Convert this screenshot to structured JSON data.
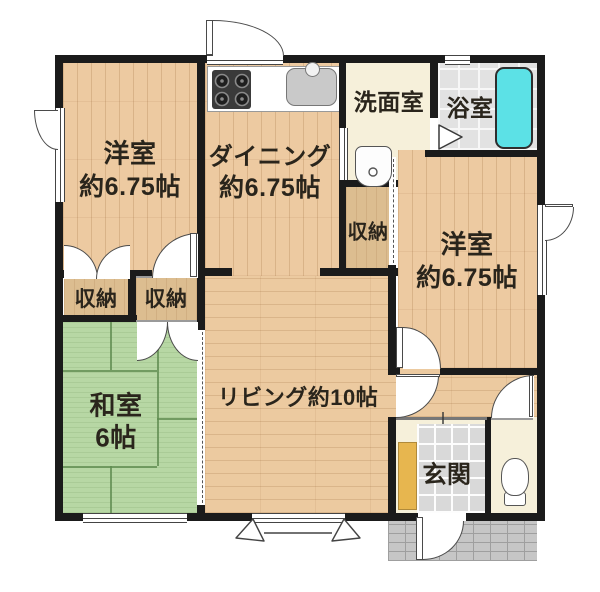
{
  "rooms": {
    "bedroom_top_left": {
      "name": "洋室",
      "size": "約6.75帖"
    },
    "dining": {
      "name": "ダイニング",
      "size": "約6.75帖"
    },
    "washroom": {
      "name": "洗面室"
    },
    "bathroom": {
      "name": "浴室"
    },
    "closet_mid": {
      "name": "収納"
    },
    "bedroom_right": {
      "name": "洋室",
      "size": "約6.75帖"
    },
    "closet_left_a": {
      "name": "収納"
    },
    "closet_left_b": {
      "name": "収納"
    },
    "japanese_room": {
      "name": "和室",
      "size": "6帖"
    },
    "living": {
      "name": "リビング約10帖"
    },
    "entrance": {
      "name": "玄関"
    }
  },
  "colors": {
    "wall": "#1b1b1b",
    "wood_floor": "#edcaa1",
    "tatami_green": "#b7d7a4",
    "closet_tan": "#dcbd90",
    "washroom_cream": "#f6f0da",
    "bath_tile_gray": "#e2e2e2",
    "bathtub_cyan": "#5ce1e6",
    "entrance_tile": "#d9d9d9",
    "porch_gray": "#c6c6c6",
    "shoe_cabinet_yellow": "#e7b64f"
  },
  "icons": {
    "stove": "gas-stove-icon",
    "kitchen_sink": "kitchen-sink-icon",
    "washbasin": "washbasin-icon",
    "toilet": "toilet-icon",
    "bathtub": "bathtub-icon"
  }
}
